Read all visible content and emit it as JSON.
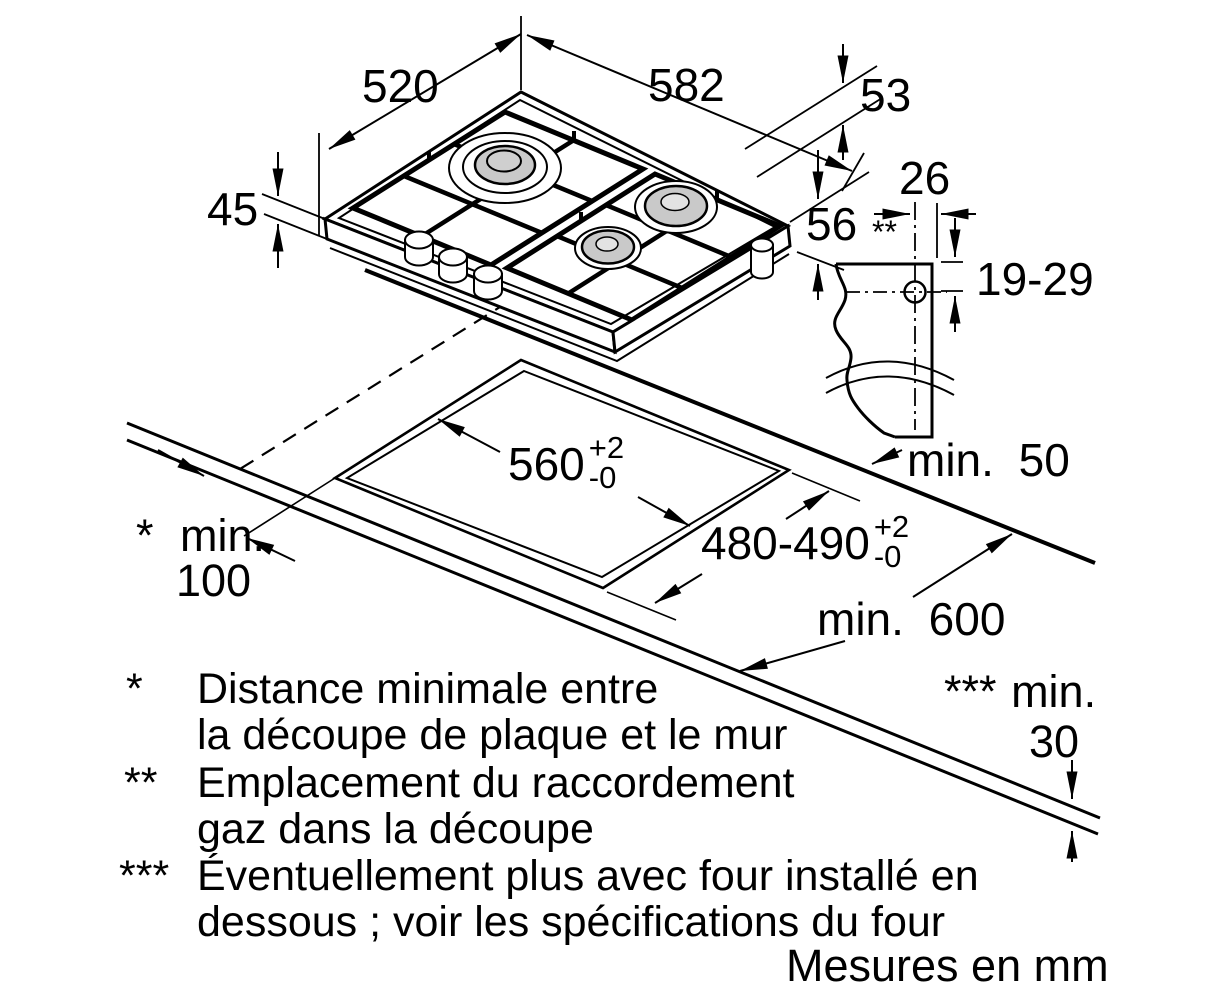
{
  "figure": {
    "units_note": "Mesures en mm",
    "colors": {
      "line": "#000000",
      "burner_fill": "#c9c9c9",
      "background": "#ffffff"
    },
    "dims": {
      "hob_depth": "520",
      "hob_width": "582",
      "grate_height": "53",
      "body_height": "45",
      "connection_side": {
        "value": "56",
        "marker": "**"
      },
      "connection_offset": "26",
      "connection_drop": "19-29",
      "edge_clearance": "min. 50",
      "cutout_width": {
        "value": "560",
        "tol_plus": "+2",
        "tol_minus": "-0"
      },
      "cutout_depth": {
        "value": "480-490",
        "tol_plus": "+2",
        "tol_minus": "-0"
      },
      "wall_clearance": {
        "marker": "*",
        "word": "min.",
        "value": "100"
      },
      "worktop_depth": "min. 600",
      "oven_clearance": {
        "marker": "***",
        "word": "min.",
        "value": "30"
      }
    },
    "footnotes": [
      {
        "marker": "*",
        "line1": "Distance minimale entre",
        "line2": "la découpe de plaque et le mur"
      },
      {
        "marker": "**",
        "line1": "Emplacement du raccordement",
        "line2": "gaz dans la découpe"
      },
      {
        "marker": "***",
        "line1": "Éventuellement plus avec four installé en",
        "line2": "dessous ; voir les spécifications du four"
      }
    ]
  }
}
